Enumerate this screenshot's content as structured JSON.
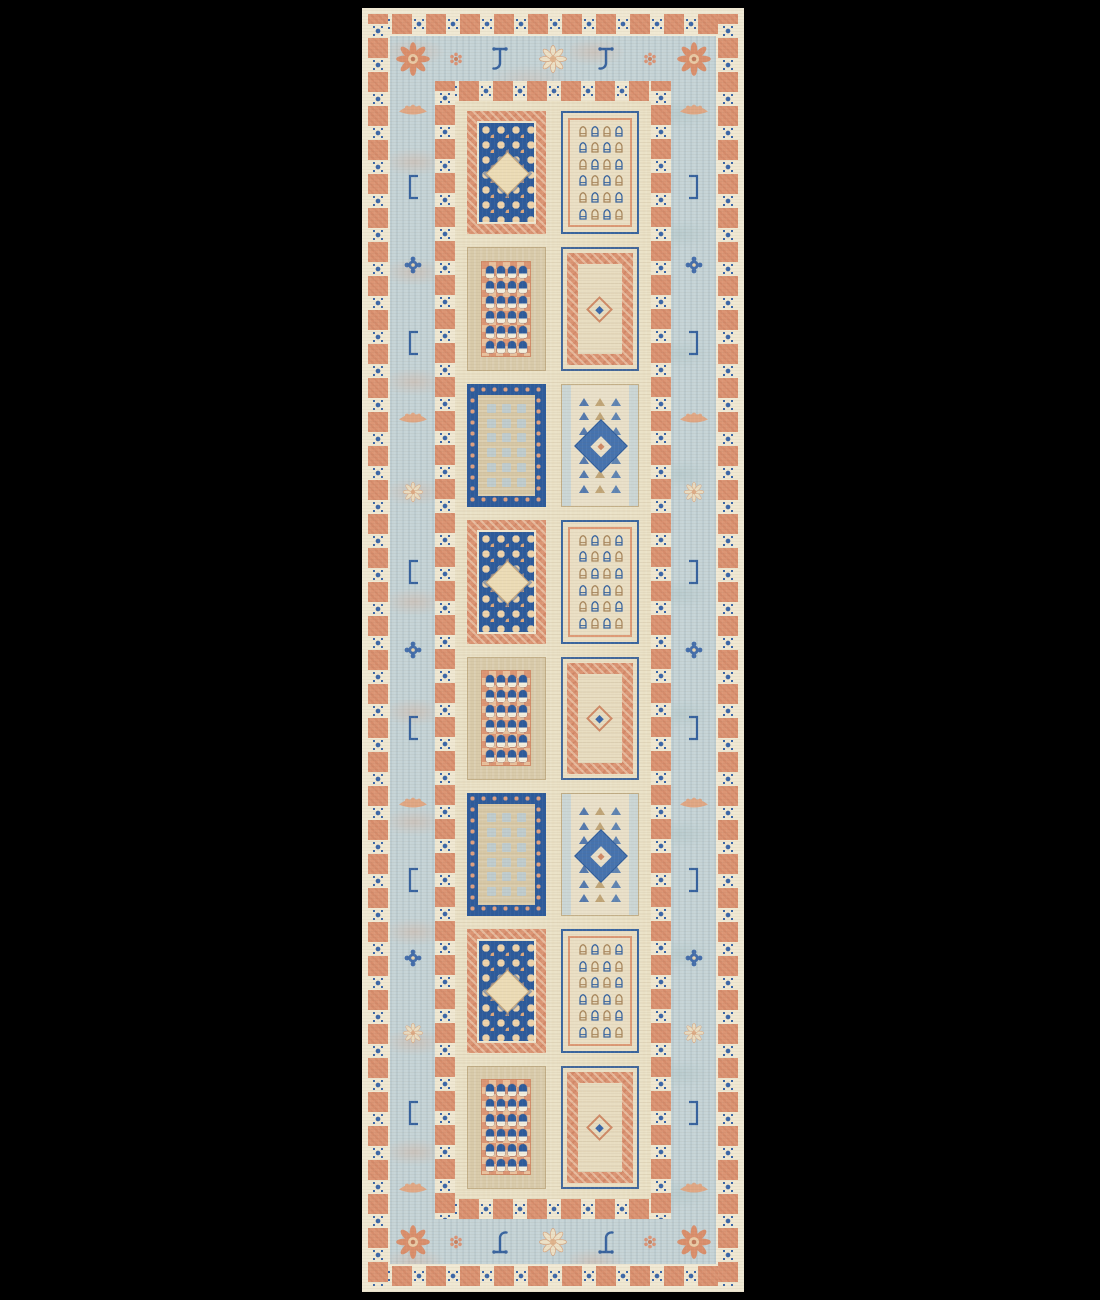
{
  "scene": {
    "type": "product-photo",
    "subject": "hand-knotted garden-panel runner rug",
    "background_color": "#000000"
  },
  "rug": {
    "palette": {
      "cream_edge": "#efe8d3",
      "cream_sq": "#f0e8d2",
      "coral": "#dc9574",
      "coral_dark": "#c8795a",
      "blue_border": "#c6d4d7",
      "navy": "#2d5b9b",
      "star_blue": "#3a66a8",
      "field_cream": "#eae1c6",
      "panel_tan": "#d8caa9",
      "pale_blue": "#bcccd1",
      "white_cream": "#f3eedd",
      "tan_outline": "#b99a68"
    },
    "borders": {
      "selvage": {
        "name": "outer-selvage"
      },
      "outer_guard": {
        "name": "outer-guard-band",
        "motif": "star-in-square"
      },
      "inner_guard": {
        "name": "inner-guard-band",
        "motif": "star-in-square"
      },
      "main": {
        "name": "main-border",
        "corner_motif": "sunburst",
        "motifs": {
          "top": [
            "rosette-coral",
            "hook",
            "palmette",
            "hook",
            "rosette-coral"
          ],
          "bottom": [
            "rosette-coral",
            "hook",
            "palmette",
            "hook",
            "rosette-coral"
          ],
          "left": [
            "boat",
            "bracket",
            "rosette-blue",
            "bracket",
            "boat",
            "palmette-small",
            "bracket",
            "rosette-blue",
            "bracket",
            "boat",
            "bracket",
            "rosette-blue",
            "palmette-small",
            "bracket",
            "boat"
          ],
          "right": [
            "boat",
            "bracket",
            "rosette-blue",
            "bracket",
            "boat",
            "palmette-small",
            "bracket",
            "rosette-blue",
            "bracket",
            "boat",
            "bracket",
            "rosette-blue",
            "palmette-small",
            "bracket",
            "boat"
          ]
        }
      }
    },
    "field": {
      "columns": 2,
      "rows": 8,
      "panel_rows": [
        {
          "left": "trellis",
          "right": "boteh"
        },
        {
          "left": "bells",
          "right": "medallion"
        },
        {
          "left": "checker",
          "right": "diamond"
        },
        {
          "left": "trellis",
          "right": "boteh"
        },
        {
          "left": "bells",
          "right": "medallion"
        },
        {
          "left": "checker",
          "right": "diamond"
        },
        {
          "left": "trellis",
          "right": "boteh"
        },
        {
          "left": "bells",
          "right": "medallion"
        }
      ],
      "panel_types": {
        "trellis": {
          "label": "navy trellis lattice with central cream diamond, coral frame"
        },
        "boteh": {
          "label": "paired boteh bell motifs on cream, navy and coral frames",
          "rows": 6,
          "cols": 4
        },
        "bells": {
          "label": "blue bells with white bases on coral checker block",
          "rows": 6,
          "cols": 4
        },
        "medallion": {
          "label": "ornate coral band with small central diamond medallion"
        },
        "checker": {
          "label": "navy dotted frame with pale blue squares on tan",
          "rows": 6,
          "cols": 3
        },
        "diamond": {
          "label": "serrated blue diamond medallion with triangle rows",
          "rows": 7,
          "cols": 3
        }
      }
    }
  }
}
